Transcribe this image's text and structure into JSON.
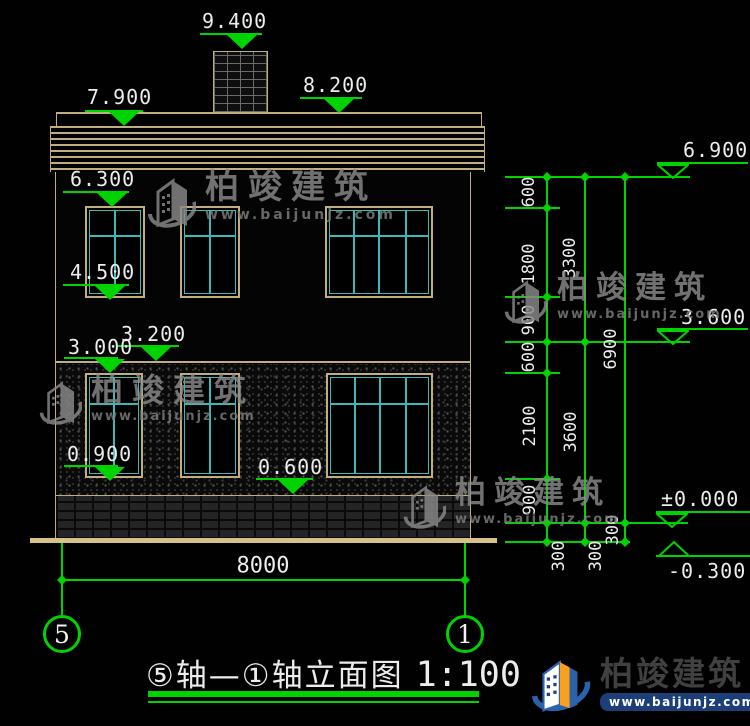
{
  "watermark": {
    "brand": "柏竣建筑",
    "url": "www.baijunjz.com"
  },
  "footer_logo": {
    "brand": "柏竣建筑",
    "url": "www.baijunjz.com"
  },
  "title": {
    "text": "⑤轴—①轴立面图",
    "scale": "1:100"
  },
  "axes": {
    "left": "5",
    "right": "1"
  },
  "bottom_dimension": "8000",
  "elevation_marks": {
    "left": [
      "9.400",
      "7.900",
      "8.200",
      "6.300",
      "4.500",
      "3.200",
      "3.000",
      "0.900",
      "0.600"
    ],
    "right": [
      "6.900",
      "3.600",
      "±0.000",
      "-0.300"
    ]
  },
  "dimension_chains": {
    "inner": [
      "600",
      "1800",
      "900",
      "600",
      "2100",
      "900",
      "300"
    ],
    "middle": [
      "3300",
      "3600",
      "300"
    ],
    "outer": [
      "6900",
      "300"
    ]
  }
}
